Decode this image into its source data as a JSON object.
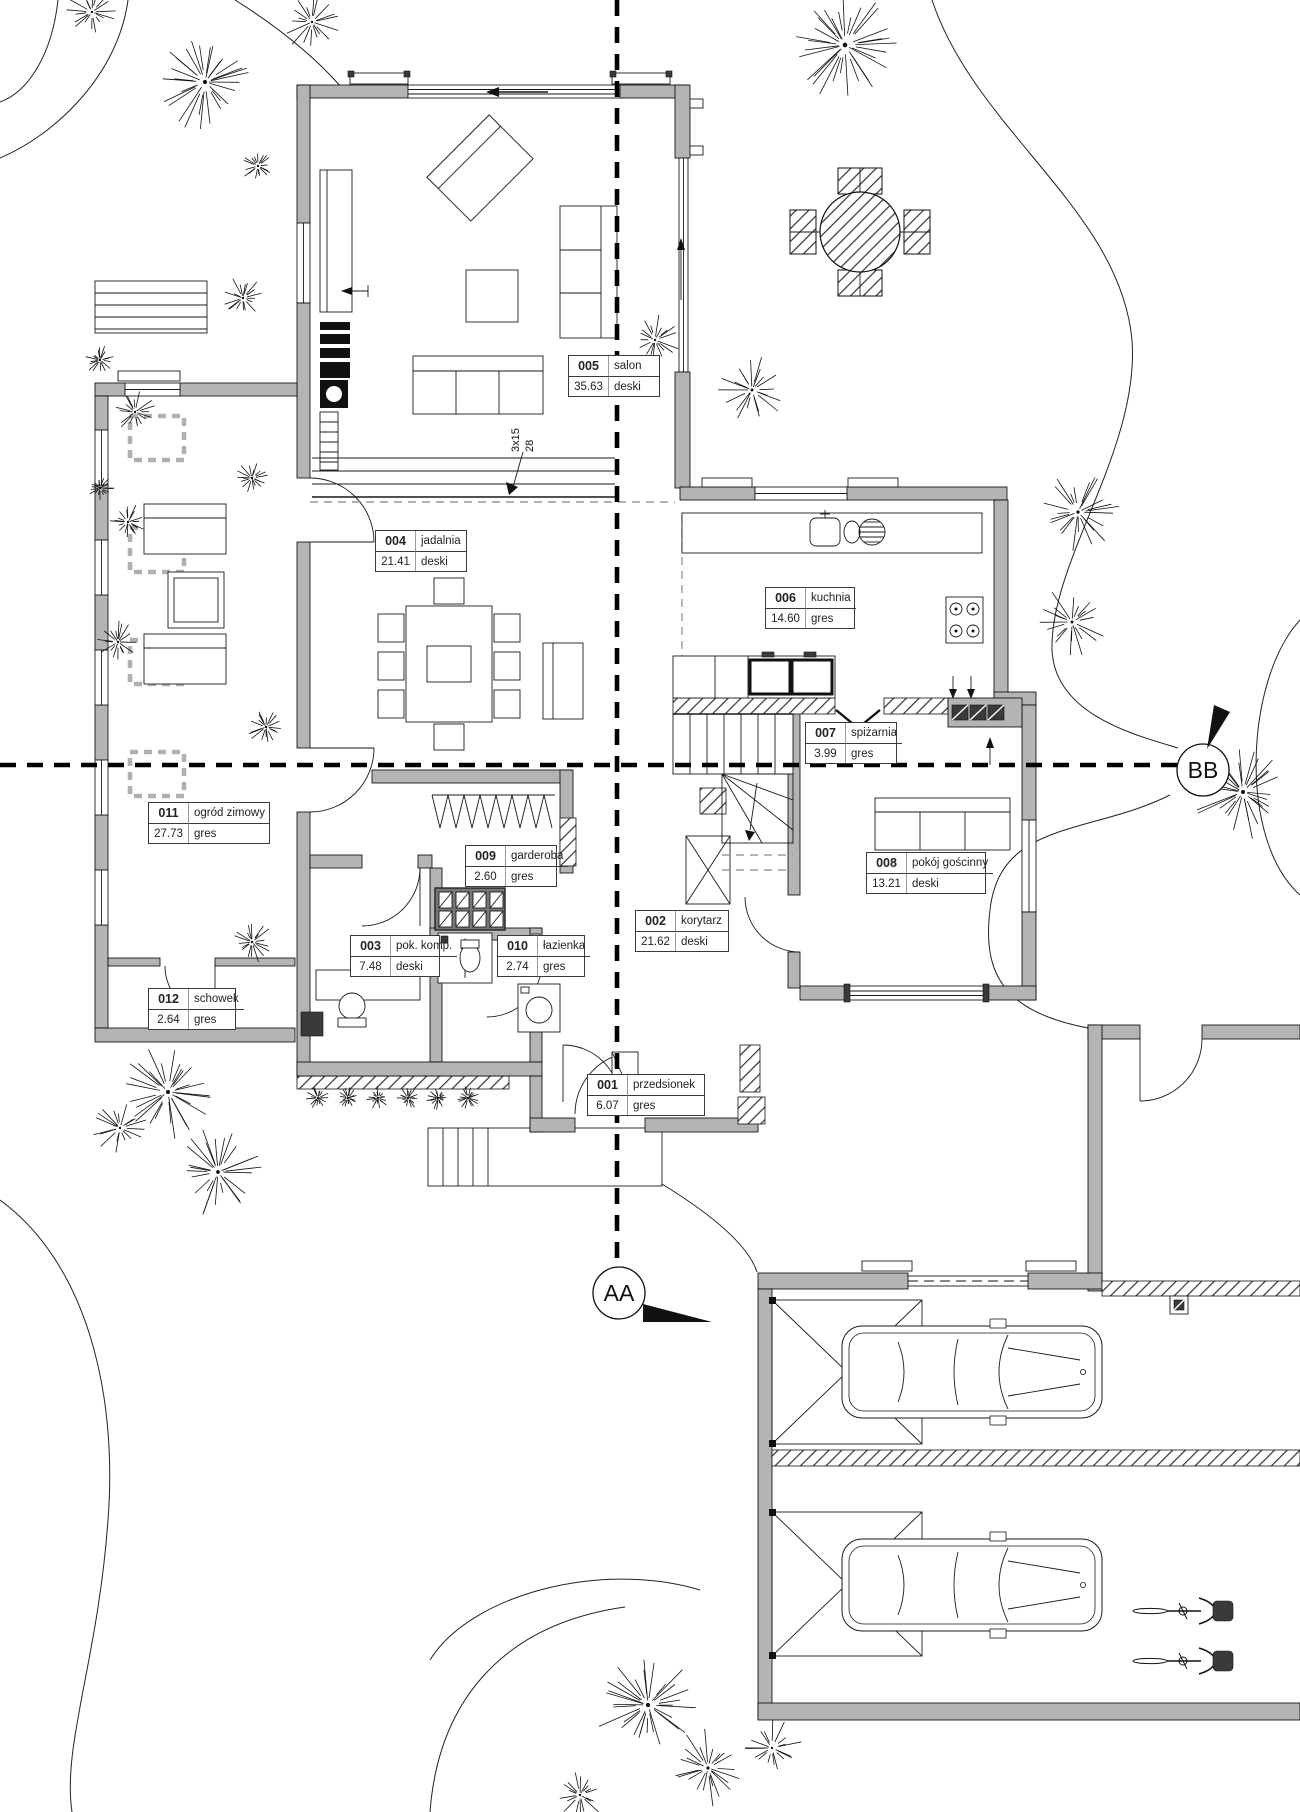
{
  "drawing": {
    "rooms": [
      {
        "number": "001",
        "name": "przedsionek",
        "area": "6.07",
        "floor": "gres"
      },
      {
        "number": "002",
        "name": "korytarz",
        "area": "21.62",
        "floor": "deski"
      },
      {
        "number": "003",
        "name": "pok. komp.",
        "area": "7.48",
        "floor": "deski"
      },
      {
        "number": "004",
        "name": "jadalnia",
        "area": "21.41",
        "floor": "deski"
      },
      {
        "number": "005",
        "name": "salon",
        "area": "35.63",
        "floor": "deski"
      },
      {
        "number": "006",
        "name": "kuchnia",
        "area": "14.60",
        "floor": "gres"
      },
      {
        "number": "007",
        "name": "spiżarnia",
        "area": "3.99",
        "floor": "gres"
      },
      {
        "number": "008",
        "name": "pokój gościnny",
        "area": "13.21",
        "floor": "deski"
      },
      {
        "number": "009",
        "name": "garderoba",
        "area": "2.60",
        "floor": "gres"
      },
      {
        "number": "010",
        "name": "łazienka",
        "area": "2.74",
        "floor": "gres"
      },
      {
        "number": "011",
        "name": "ogród zimowy",
        "area": "27.73",
        "floor": "gres"
      },
      {
        "number": "012",
        "name": "schowek",
        "area": "2.64",
        "floor": "gres"
      }
    ],
    "section_markers": {
      "aa": "AA",
      "bb": "BB"
    },
    "stair_note": {
      "line1": "3x15",
      "line2": "28"
    },
    "colors": {
      "wall_fill": "#b4b4b4",
      "line": "#000000",
      "dashed_gray": "#9a9a9a"
    }
  }
}
